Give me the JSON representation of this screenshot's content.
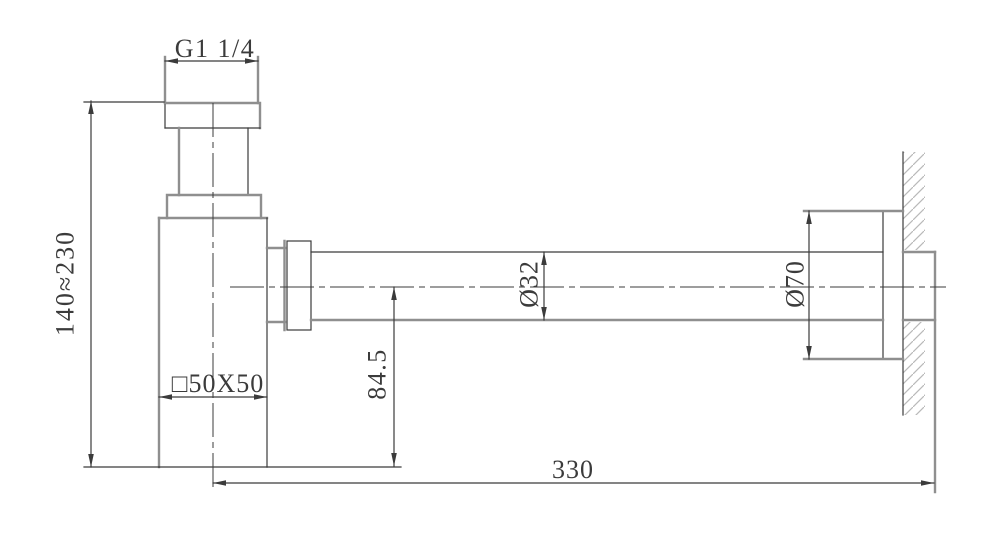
{
  "drawing": {
    "type": "technical-drawing",
    "labels": {
      "thread_size": "G1 1/4",
      "adjustable_height": "140≈230",
      "body_section": "□50X50",
      "outlet_drop": "84.5",
      "pipe_diameter": "Ø32",
      "escutcheon_diameter": "Ø70",
      "wall_distance": "330"
    },
    "colors": {
      "background": "#ffffff",
      "object_line": "#8f8f8f",
      "dim_line": "#3b3b3b",
      "hatch_line": "#b9b9b9"
    }
  }
}
